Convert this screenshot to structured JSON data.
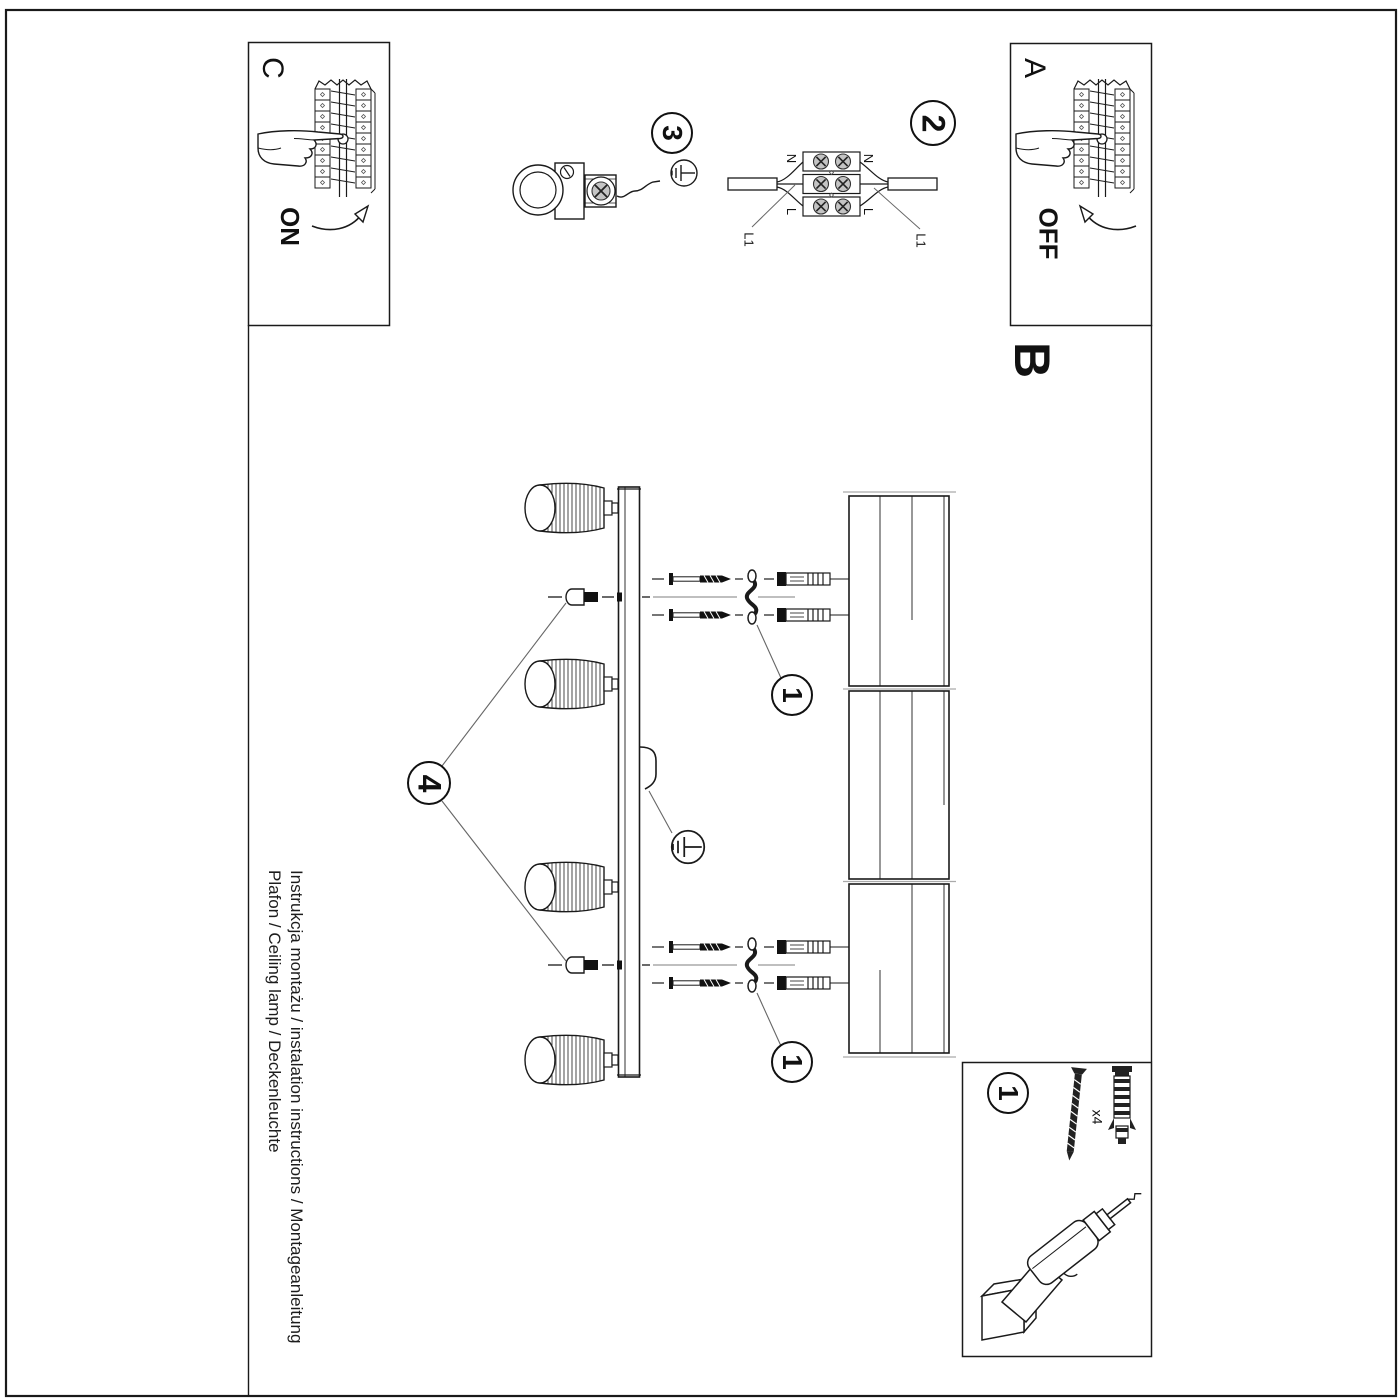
{
  "doc": {
    "steps": {
      "a_label": "A",
      "b_label": "B",
      "c_label": "C",
      "on_label": "ON",
      "off_label": "OFF"
    },
    "callouts": {
      "step1": "1",
      "step2": "2",
      "step3": "3",
      "step4": "4"
    },
    "wiring_labels": {
      "neutral": "N",
      "live": "L",
      "l1": "L1"
    },
    "parts_box": {
      "callout": "1",
      "screw_qty": "x4"
    },
    "footer": {
      "title_line": "Instrukcja montażu / instalation instructions / Montageanleitung",
      "product_line": "Plafon / Ceiling lamp / Deckenleuchte"
    },
    "colors": {
      "ink": "#1a1a1a",
      "centerline": "#999999",
      "screw_fill": "#c4c4c4"
    }
  }
}
